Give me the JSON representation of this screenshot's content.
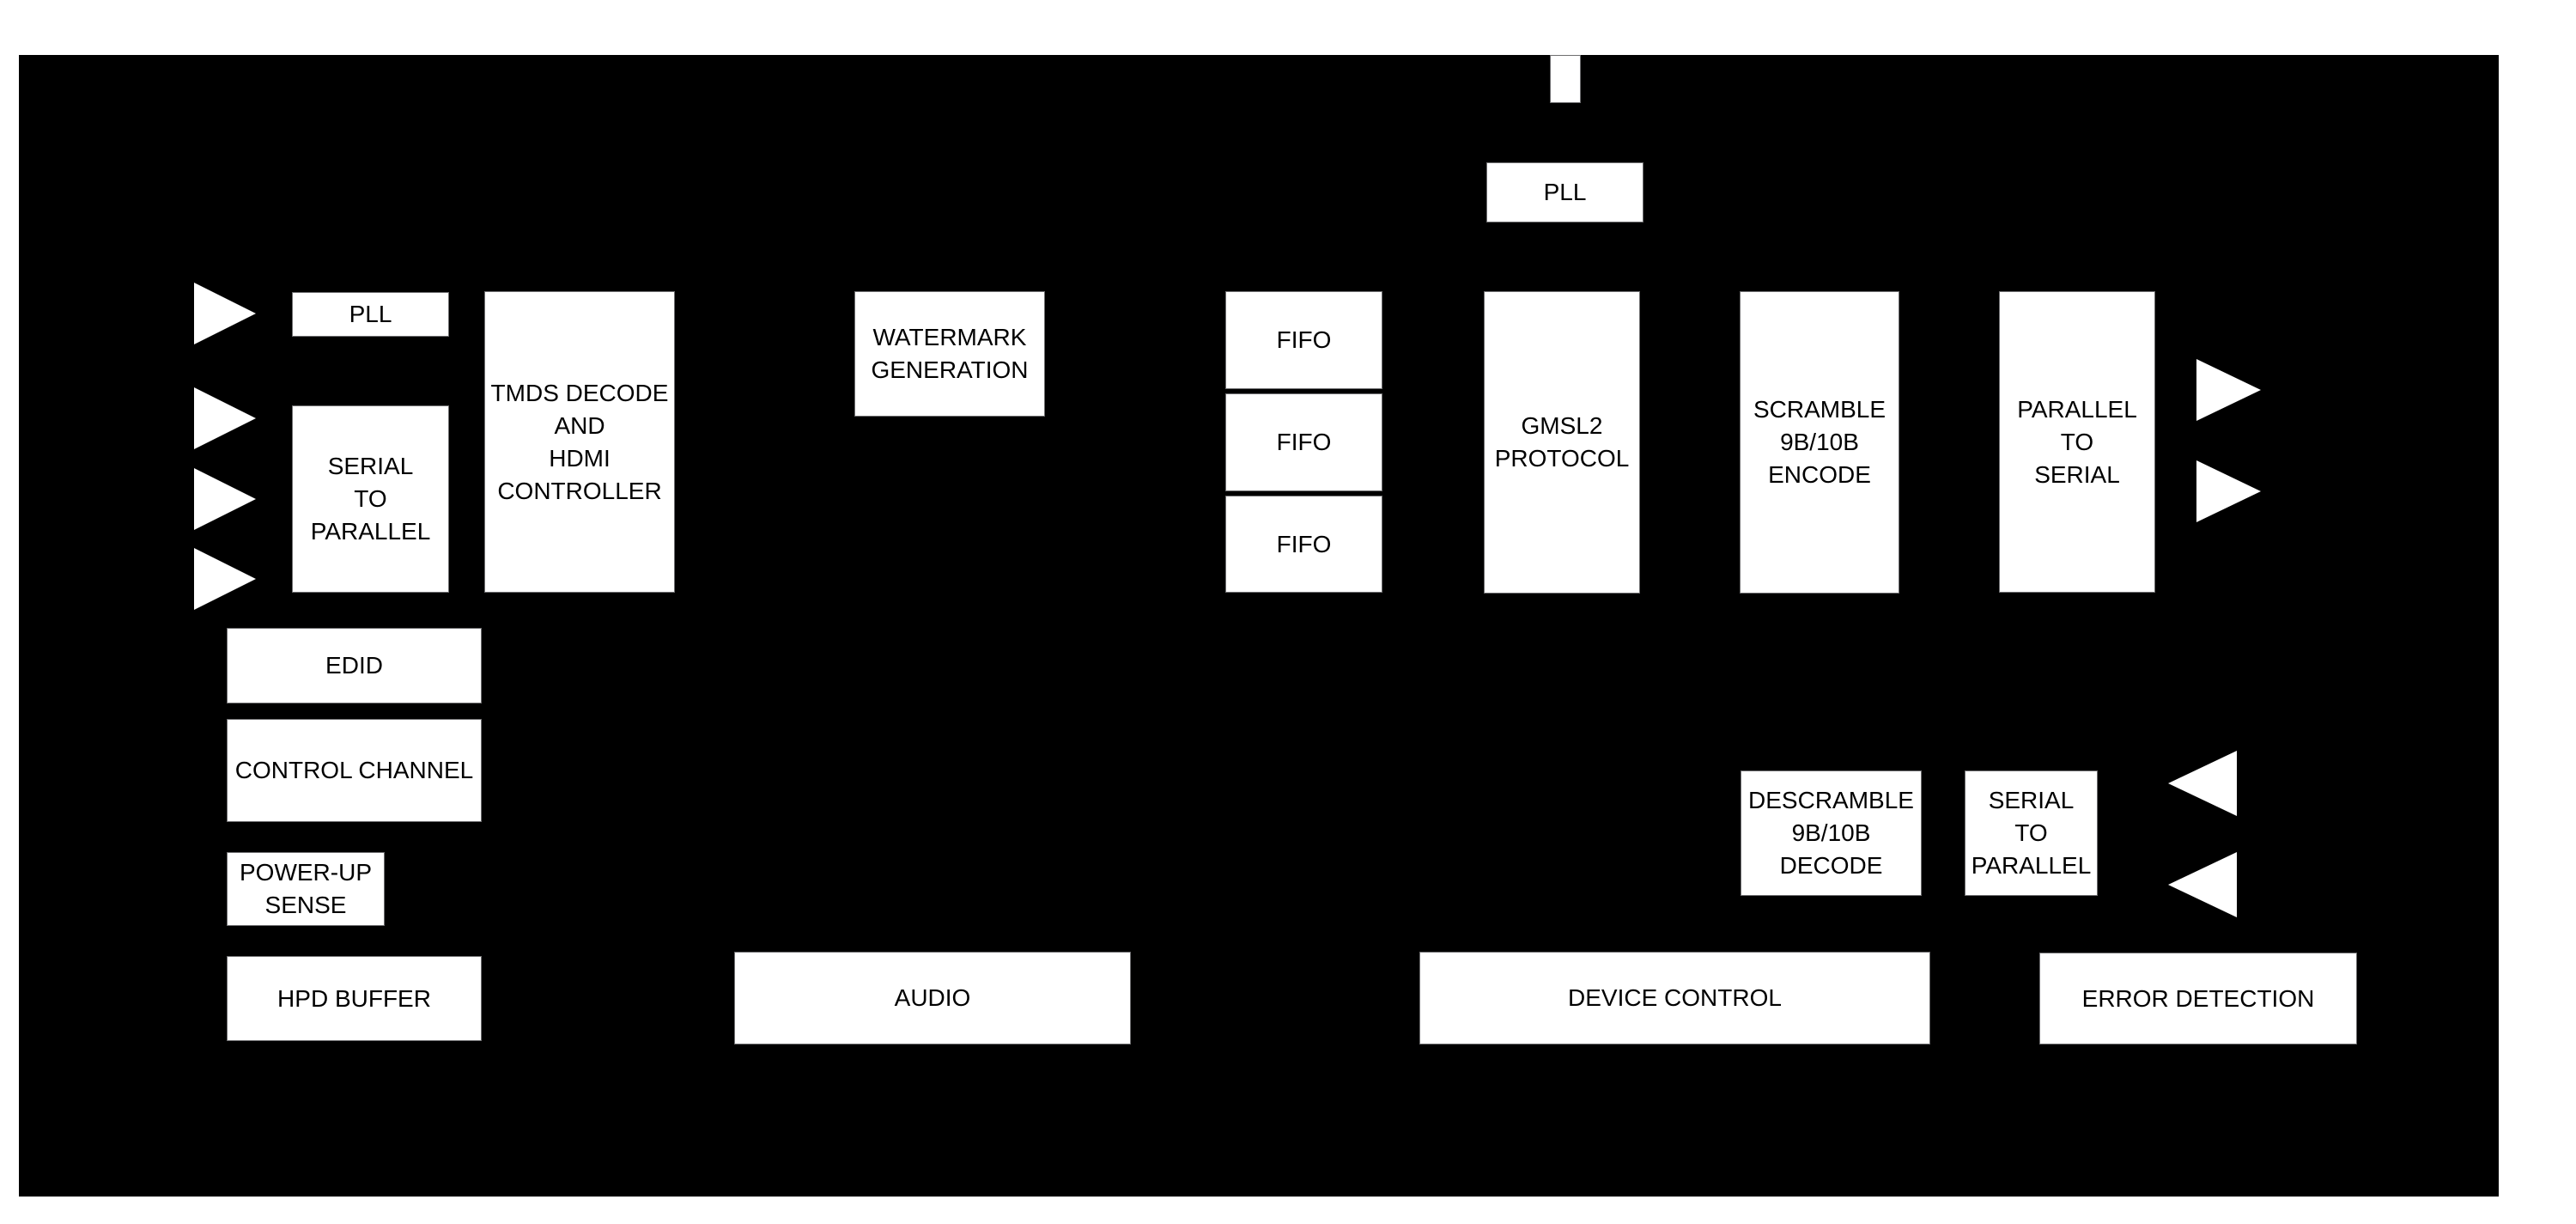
{
  "diagram": {
    "type": "functional-block-diagram",
    "colors": {
      "page_background": "#ffffff",
      "chip_fill": "#000000",
      "block_fill": "#ffffff",
      "block_text": "#000000",
      "arrow_fill": "#ffffff"
    },
    "blocks": {
      "pll_top": {
        "label": "PLL"
      },
      "pll_left": {
        "label": "PLL"
      },
      "serial_to_parallel_in": {
        "lines": [
          "SERIAL",
          "TO",
          "PARALLEL"
        ]
      },
      "tmds_decode": {
        "lines": [
          "TMDS DECODE",
          "AND",
          "HDMI",
          "CONTROLLER"
        ]
      },
      "watermark_generation": {
        "lines": [
          "WATERMARK",
          "GENERATION"
        ]
      },
      "fifo_1": {
        "label": "FIFO"
      },
      "fifo_2": {
        "label": "FIFO"
      },
      "fifo_3": {
        "label": "FIFO"
      },
      "gmsl2_protocol": {
        "lines": [
          "GMSL2",
          "PROTOCOL"
        ]
      },
      "scramble_encode": {
        "lines": [
          "SCRAMBLE",
          "9B/10B",
          "ENCODE"
        ]
      },
      "parallel_to_serial": {
        "lines": [
          "PARALLEL",
          "TO",
          "SERIAL"
        ]
      },
      "edid": {
        "label": "EDID"
      },
      "control_channel": {
        "label": "CONTROL CHANNEL"
      },
      "power_up_sense": {
        "lines": [
          "POWER-UP",
          "SENSE"
        ]
      },
      "hpd_buffer": {
        "label": "HPD BUFFER"
      },
      "audio": {
        "label": "AUDIO"
      },
      "descramble_decode": {
        "lines": [
          "DESCRAMBLE",
          "9B/10B",
          "DECODE"
        ]
      },
      "serial_to_parallel_out": {
        "lines": [
          "SERIAL",
          "TO",
          "PARALLEL"
        ]
      },
      "device_control": {
        "label": "DEVICE CONTROL"
      },
      "error_detection": {
        "label": "ERROR DETECTION"
      }
    },
    "arrows": {
      "left_inputs": {
        "direction": "right",
        "count": 4
      },
      "right_outputs": {
        "direction": "right",
        "count": 2
      },
      "right_reverse_inputs": {
        "direction": "left",
        "count": 2
      }
    }
  }
}
